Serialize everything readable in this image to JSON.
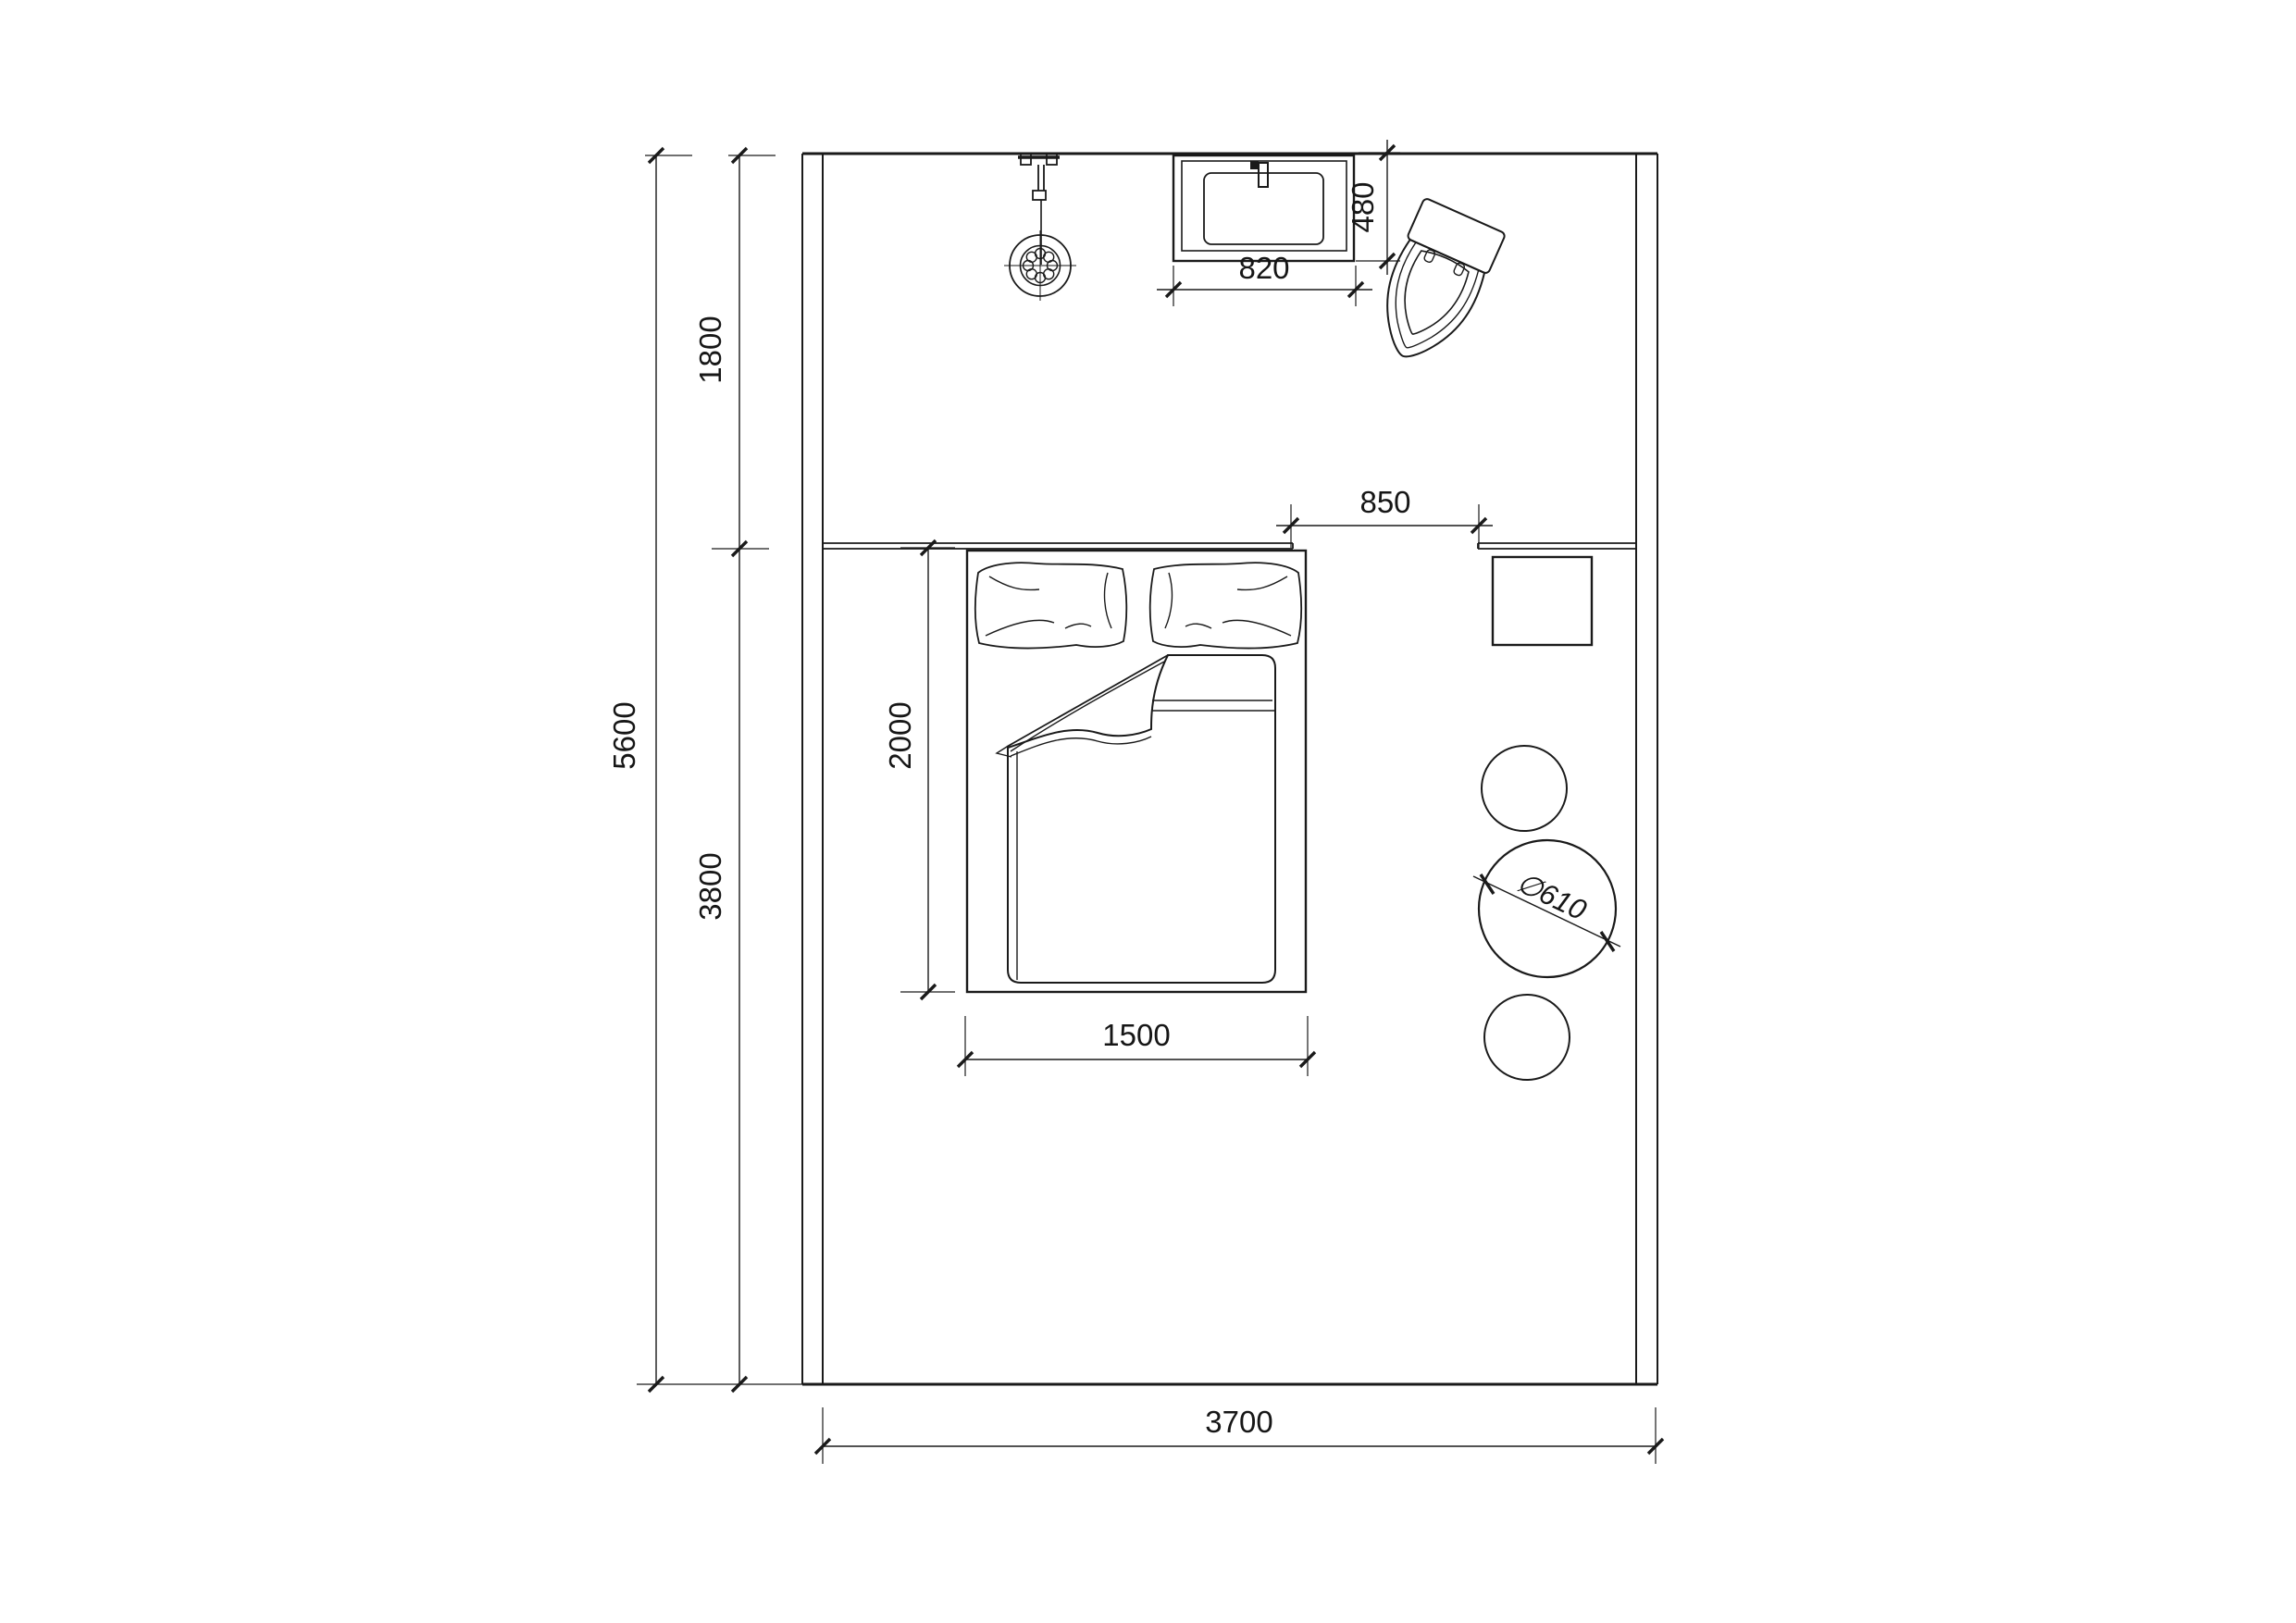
{
  "canvas": {
    "background": "#ffffff",
    "ink": "#1a1a1a"
  },
  "floor_plan": {
    "type": "bedroom-with-bath-zone-plan",
    "dimensions": {
      "total_height": "5600",
      "upper_zone_height": "1800",
      "lower_zone_height": "3800",
      "total_width": "3700",
      "bed_length": "2000",
      "bed_width": "1500",
      "vanity_width": "820",
      "vanity_depth": "480",
      "shelf_gap": "850",
      "table_diameter": "∅610"
    },
    "furniture_symbols": [
      "shower-head",
      "vanity-sink",
      "faucet",
      "toilet",
      "headboard-shelf",
      "wall-shelf",
      "double-bed",
      "pillow",
      "duvet",
      "nightstand",
      "stool-small",
      "round-table"
    ]
  }
}
